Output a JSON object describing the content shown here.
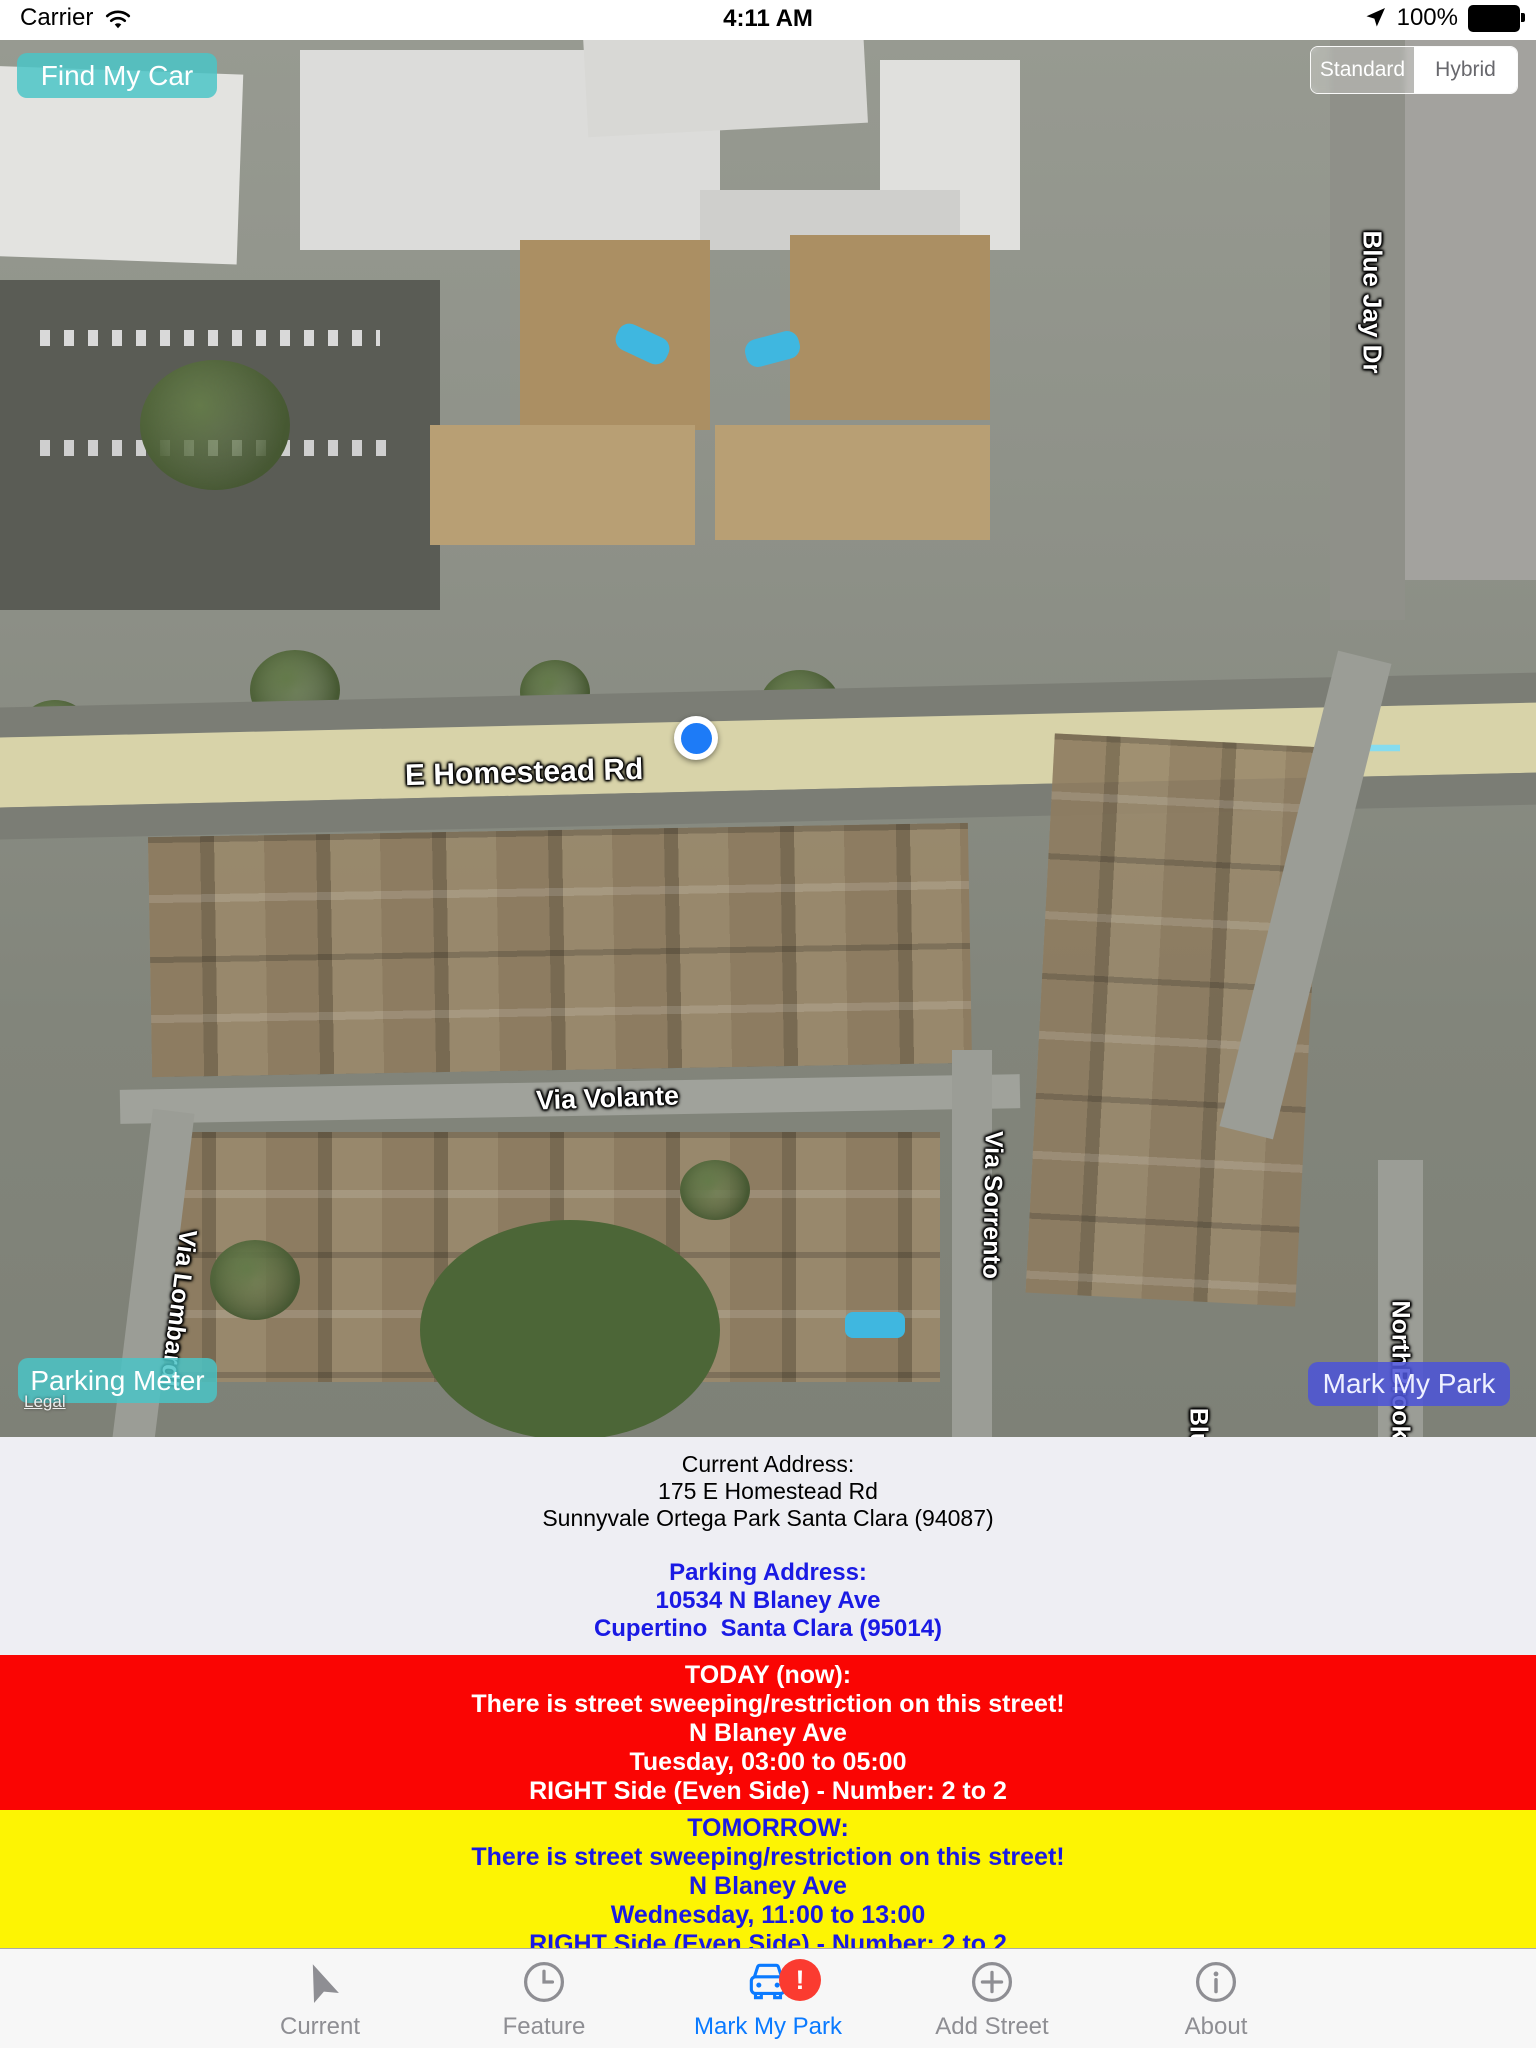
{
  "status_bar": {
    "carrier": "Carrier",
    "time": "4:11 AM",
    "battery_pct": "100%"
  },
  "map": {
    "find_my_car_label": "Find My Car",
    "map_type": {
      "standard": "Standard",
      "hybrid": "Hybrid",
      "selected": "Hybrid"
    },
    "parking_meter_label": "Parking Meter",
    "legal_label": "Legal",
    "mark_my_park_label": "Mark My Park",
    "street_labels": [
      {
        "id": "e-homestead-rd",
        "text": "E Homestead Rd"
      },
      {
        "id": "via-volante",
        "text": "Via Volante"
      },
      {
        "id": "via-lombardi",
        "text": "Via Lombardi"
      },
      {
        "id": "via-sorrento",
        "text": "Via Sorrento"
      },
      {
        "id": "blue-jay-dr",
        "text": "Blue Jay Dr"
      },
      {
        "id": "northbrook",
        "text": "NorthBrook"
      },
      {
        "id": "blu-partial",
        "text": "Blu"
      }
    ]
  },
  "info": {
    "current": {
      "title": "Current Address:",
      "line1": "175 E Homestead Rd",
      "line2": "Sunnyvale Ortega Park Santa Clara (94087)"
    },
    "parking": {
      "title": "Parking Address:",
      "line1": "10534 N Blaney Ave",
      "line2": "Cupertino  Santa Clara (95014)"
    }
  },
  "alerts": {
    "today": {
      "title": "TODAY (now):",
      "line1": "There is street sweeping/restriction on this street!",
      "line2": "N Blaney Ave",
      "line3": "Tuesday, 03:00 to 05:00",
      "line4": "RIGHT Side (Even Side) - Number: 2 to 2",
      "bg_color": "#fa0503",
      "text_color": "#ffffff"
    },
    "tomorrow": {
      "title": "TOMORROW:",
      "line1": "There is street sweeping/restriction on this street!",
      "line2": "N Blaney Ave",
      "line3": "Wednesday, 11:00 to 13:00",
      "line4": "RIGHT Side (Even Side) - Number: 2 to 2",
      "bg_color": "#fdf403",
      "text_color": "#1a1ae4"
    }
  },
  "tab_bar": {
    "items": [
      {
        "label": "Current",
        "icon": "navigation-arrow-icon",
        "active": false
      },
      {
        "label": "Feature",
        "icon": "clock-icon",
        "active": false
      },
      {
        "label": "Mark My Park",
        "icon": "car-icon",
        "active": true,
        "badge": "!"
      },
      {
        "label": "Add Street",
        "icon": "plus-circle-icon",
        "active": false
      },
      {
        "label": "About",
        "icon": "info-circle-icon",
        "active": false
      }
    ],
    "active_color": "#0a7aff",
    "inactive_color": "#8e8e93",
    "badge_color": "#fb3b30"
  }
}
